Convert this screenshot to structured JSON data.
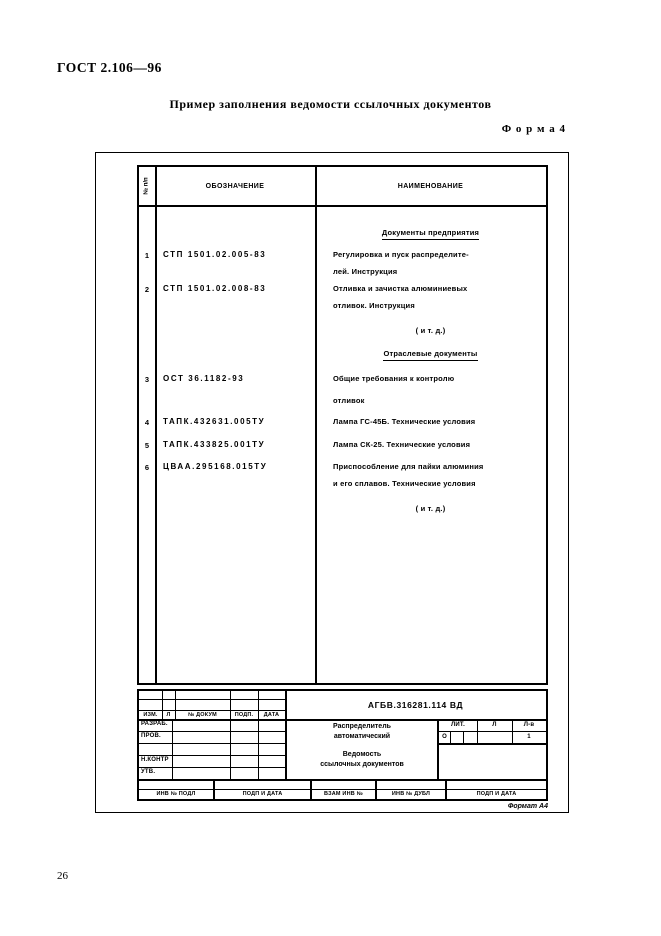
{
  "page": {
    "standard_number": "ГОСТ 2.106—96",
    "title": "Пример заполнения ведомости ссылочных документов",
    "form_label": "Ф о р м а  4",
    "format_note": "Формат А4",
    "page_number": "26"
  },
  "table": {
    "header": {
      "num": "№ п/п",
      "designation": "ОБОЗНАЧЕНИЕ",
      "name": "НАИМЕНОВАНИЕ"
    },
    "section1_heading": "Документы предприятия",
    "section2_heading": "Отраслевые документы",
    "etc1": "( и т. д.)",
    "etc2": "( и т. д.)",
    "rows": [
      {
        "num": "1",
        "designation": "СТП 1501.02.005-83",
        "name_line1": "Регулировка и пуск распределите-",
        "name_line2": "лей. Инструкция"
      },
      {
        "num": "2",
        "designation": "СТП 1501.02.008-83",
        "name_line1": "Отливка и зачистка алюминиевых",
        "name_line2": "отливок. Инструкция"
      },
      {
        "num": "3",
        "designation": "ОСТ 36.1182-93",
        "name_line1": "Общие требования к контролю",
        "name_line2": "отливок"
      },
      {
        "num": "4",
        "designation": "ТАПК.432631.005ТУ",
        "name_line1": "Лампа ГС-45Б. Технические условия"
      },
      {
        "num": "5",
        "designation": "ТАПК.433825.001ТУ",
        "name_line1": "Лампа СК-25. Технические условия"
      },
      {
        "num": "6",
        "designation": "ЦВАА.295168.015ТУ",
        "name_line1": "Приспособление для пайки алюминия",
        "name_line2": "и его сплавов. Технические условия"
      }
    ]
  },
  "title_block": {
    "designation": "АГБВ.316281.114 ВД",
    "change_row": {
      "izm": "ИЗМ.",
      "list": "Л",
      "doc_num": "№ ДОКУМ",
      "podp": "ПОДП.",
      "data": "ДАТА"
    },
    "roles": {
      "razrab": "РАЗРАБ.",
      "prov": "ПРОВ.",
      "nkontr": "Н.КОНТР",
      "utv": "УТВ."
    },
    "product_line1": "Распределитель",
    "product_line2": "автоматический",
    "doc_line1": "Ведомость",
    "doc_line2": "ссылочных документов",
    "lit": {
      "lit_label": "ЛИТ.",
      "list_label": "Л",
      "listov_label": "Л-в",
      "lit_value": "О",
      "listov_value": "1"
    },
    "bottom_labels": [
      "ИНВ № ПОДЛ",
      "ПОДП И ДАТА",
      "ВЗАМ ИНВ №",
      "ИНВ № ДУБЛ",
      "ПОДП И ДАТА"
    ]
  }
}
